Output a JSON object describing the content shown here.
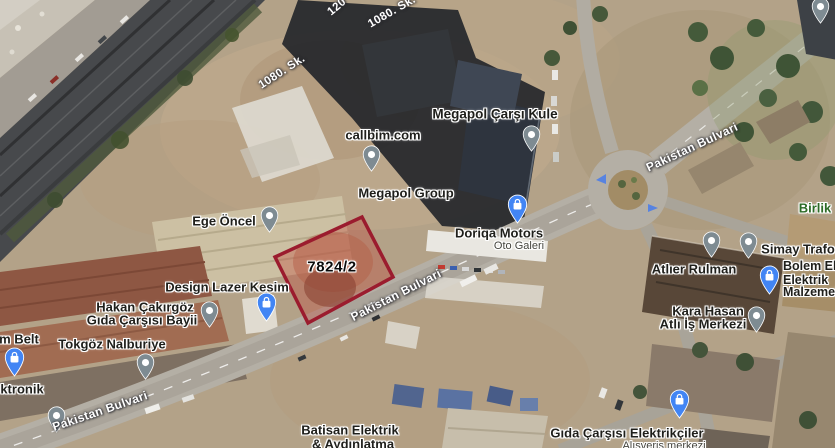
{
  "map_overlay": {
    "parcel": {
      "label": "7824/2",
      "outline_color": "#9b1c2e",
      "fill_color": "rgba(190,62,48,0.33)"
    }
  },
  "streets": [
    {
      "text": "120"
    },
    {
      "text": "1080. Sk."
    },
    {
      "text": "1080. Sk."
    },
    {
      "text": "Pakistan Bulvari"
    },
    {
      "text": "Pakistan Bulvari"
    },
    {
      "text": "Pakistan Bulvari"
    }
  ],
  "pois": [
    {
      "name": "callbim.com"
    },
    {
      "name": "Megapol Çarşı Kule"
    },
    {
      "name": "Megapol Group"
    },
    {
      "name": "Doriqa Motors",
      "subtitle": "Oto Galeri"
    },
    {
      "name": "Ege Öncel"
    },
    {
      "name": "Design Lazer Kesim"
    },
    {
      "line1": "Hakan Çakırgöz",
      "line2": "Gıda Çarşısı Bayii"
    },
    {
      "name": "m Belt"
    },
    {
      "name": "Tokgöz Nalburiye"
    },
    {
      "name": "ktronik"
    },
    {
      "name": "Atlıer Rulman"
    },
    {
      "name": "Simay Trafo"
    },
    {
      "line1": "Bolem Elektrik",
      "line2": "Elektrik",
      "line3": "Malzemeleri"
    },
    {
      "line1": "Kara Hasan",
      "line2": "Atlı İş Merkezi"
    },
    {
      "line1": "Batisan Elektrik",
      "line2": "& Aydınlatma"
    },
    {
      "name": "Gıda Çarşısı Elektrikçiler",
      "subtitle": "Alışveriş merkezi"
    },
    {
      "name": "Birlik"
    }
  ],
  "colors": {
    "poi_pin_gray": "#7e8b92",
    "shopping_pin_blue": "#4285f4",
    "park_label_green": "#2c6b26",
    "street_label_white": "#ffffff",
    "parcel_red": "#9b1c2e"
  }
}
